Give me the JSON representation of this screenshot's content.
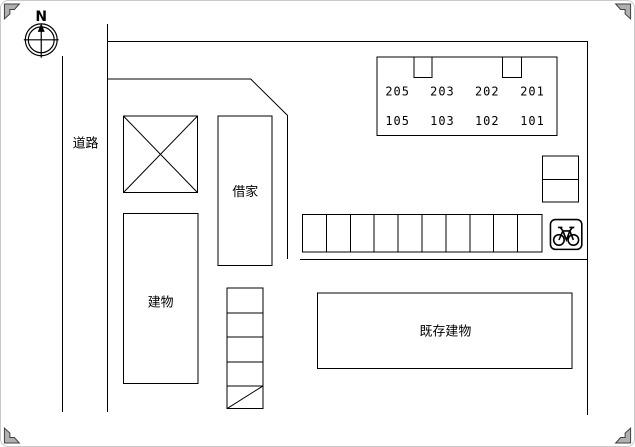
{
  "compass": {
    "north_label": "N"
  },
  "road": {
    "label": "道路"
  },
  "buildings": {
    "rental_house": {
      "label": "借家"
    },
    "main_building": {
      "label": "建物"
    },
    "existing_building": {
      "label": "既存建物"
    },
    "apartment": {
      "upper_rooms": [
        "205",
        "203",
        "202",
        "201"
      ],
      "lower_rooms": [
        "105",
        "103",
        "102",
        "101"
      ]
    }
  },
  "parking": {
    "car_spaces": 10,
    "bicycle_icon": "bicycle-icon"
  },
  "colors": {
    "line": "#000000",
    "background": "#ffffff",
    "crop_marks": "#b0b0b0"
  }
}
